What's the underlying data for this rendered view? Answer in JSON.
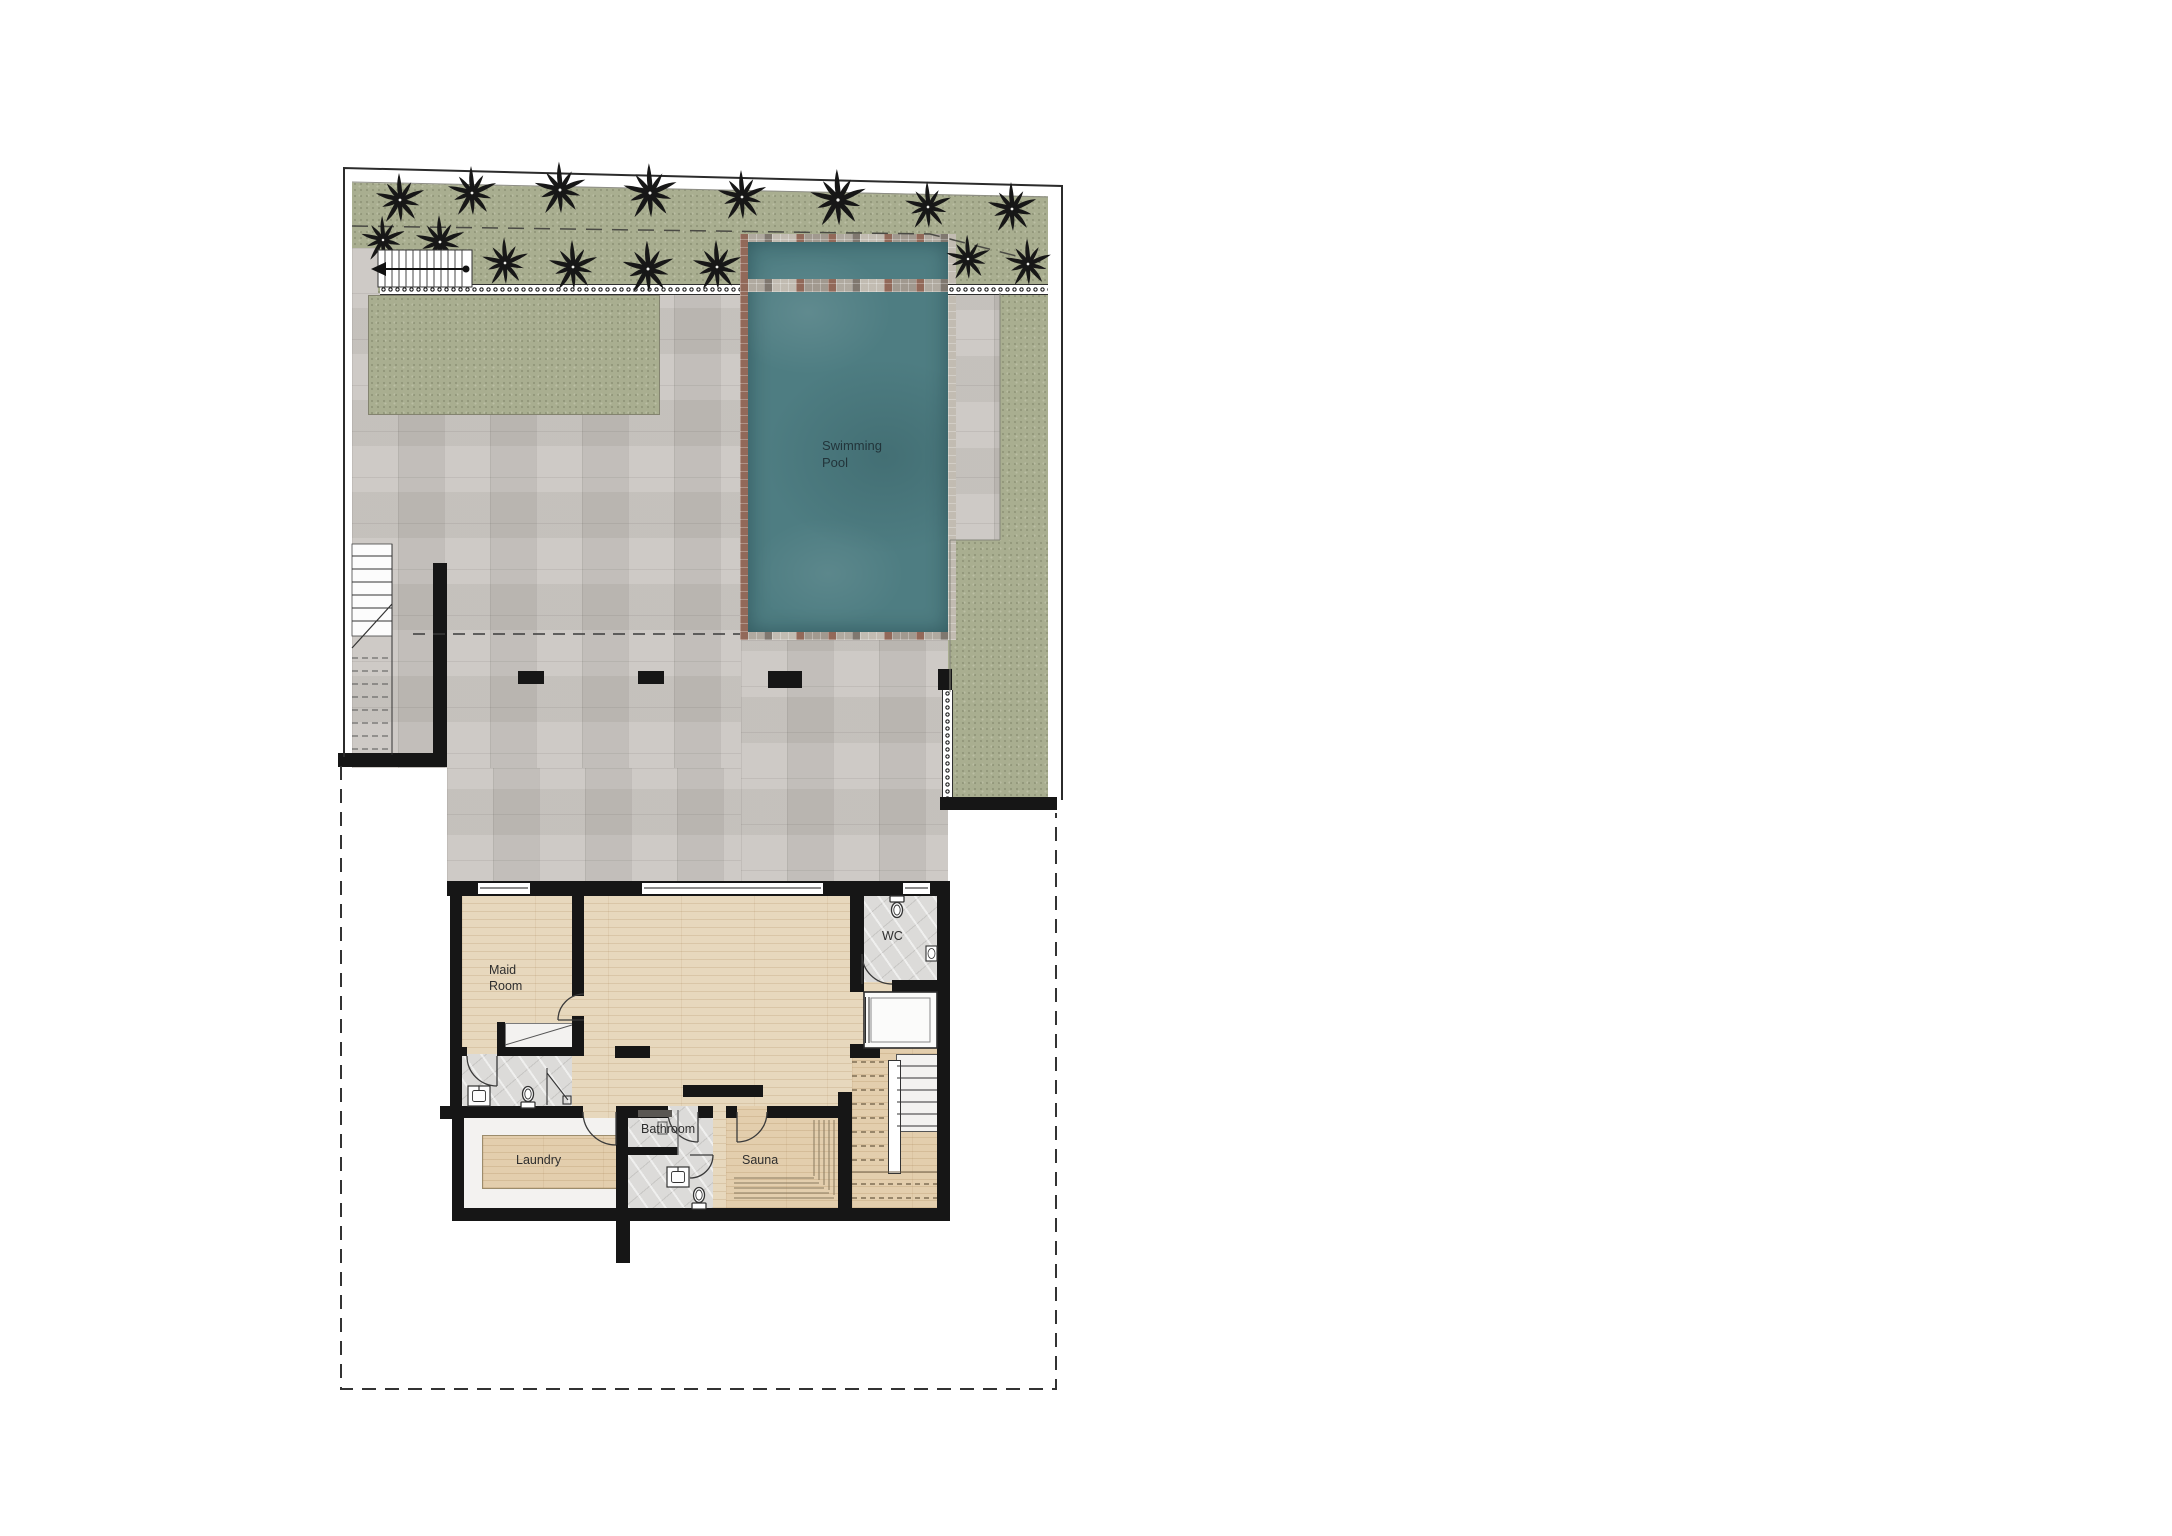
{
  "plan": {
    "rooms": {
      "swimming_pool": "Swimming Pool",
      "maid_room": "Maid Room",
      "wc": "WC",
      "bathroom": "Bathroom",
      "laundry": "Laundry",
      "sauna": "Sauna"
    },
    "colors": {
      "pool_water": "#4e7d82",
      "grass": "#a9ae90",
      "pavers": "#c8c4bf",
      "wood_floor": "#e7d8bd",
      "sauna_wood": "#e3cead",
      "marble": "#dcdbd9",
      "wall": "#161616",
      "pool_border_accent": "#8e5f4e"
    }
  }
}
